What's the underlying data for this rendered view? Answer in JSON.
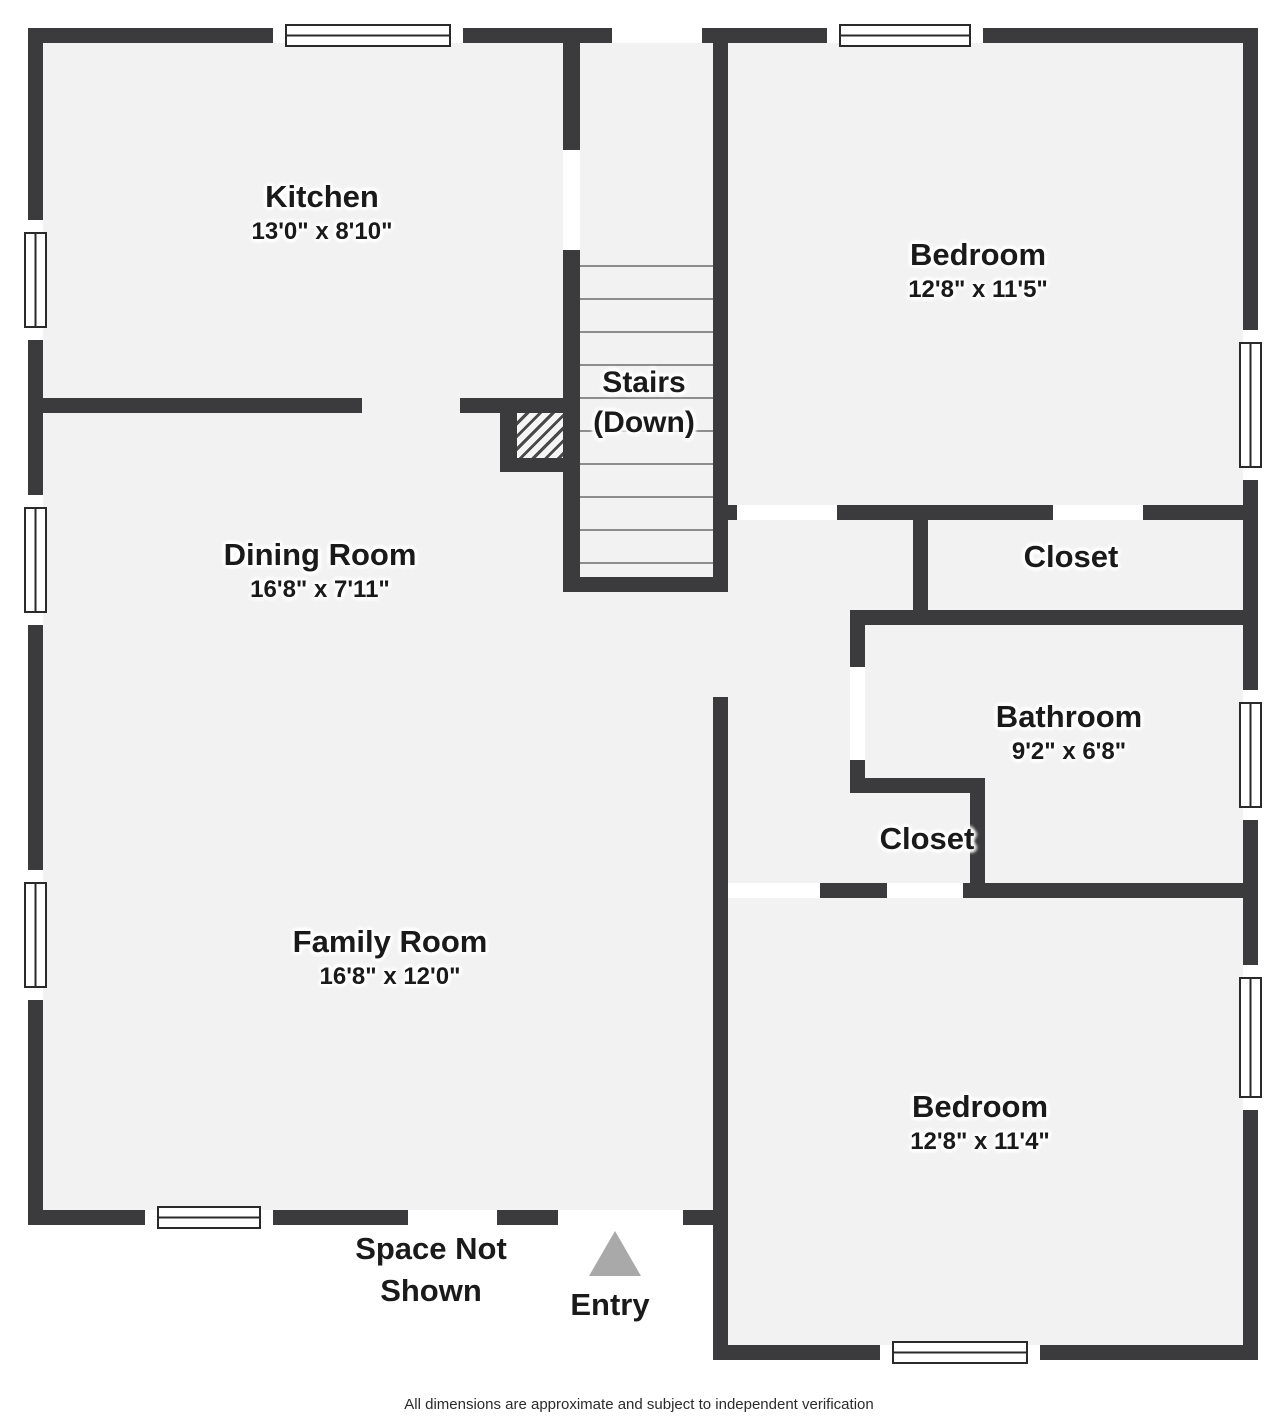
{
  "floorplan": {
    "rooms": [
      {
        "id": "kitchen",
        "name": "Kitchen",
        "dims": "13'0\" x 8'10\""
      },
      {
        "id": "bedroom-top",
        "name": "Bedroom",
        "dims": "12'8\" x 11'5\""
      },
      {
        "id": "stairs",
        "name": "Stairs",
        "dims": "(Down)"
      },
      {
        "id": "dining-room",
        "name": "Dining Room",
        "dims": "16'8\" x 7'11\""
      },
      {
        "id": "closet-top",
        "name": "Closet"
      },
      {
        "id": "bathroom",
        "name": "Bathroom",
        "dims": "9'2\" x 6'8\""
      },
      {
        "id": "closet-small",
        "name": "Closet"
      },
      {
        "id": "family-room",
        "name": "Family Room",
        "dims": "16'8\" x 12'0\""
      },
      {
        "id": "bedroom-bottom",
        "name": "Bedroom",
        "dims": "12'8\" x 11'4\""
      }
    ],
    "annotations": {
      "space_not_shown": "Space Not Shown",
      "entry": "Entry"
    },
    "footer": "All dimensions are approximate and subject to independent verification",
    "colors": {
      "wall": "#3b3b3d",
      "floor": "#f2f2f3",
      "window_frame": "#2a2a2a",
      "entry_arrow": "#a9a9a9",
      "text": "#1a1a1a",
      "tread": "#8d8d8d"
    }
  }
}
